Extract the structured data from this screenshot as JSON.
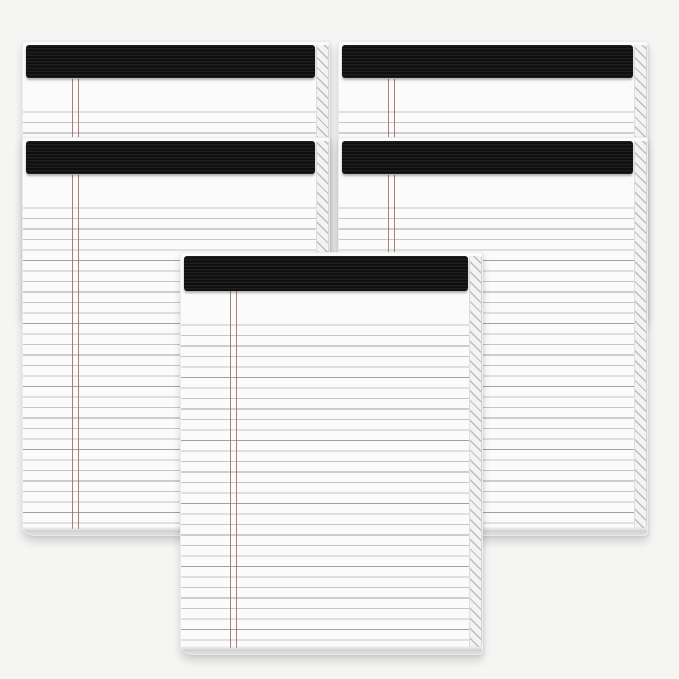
{
  "scene": {
    "title": "Five ruled writing pads with black headband bindings on a light gray backdrop",
    "pad_count": 5,
    "background_color": "#f5f5f4",
    "colors": {
      "binding": "#0d0d0d",
      "binding_texture": "#1f1f1f",
      "paper": "#fbfbfb",
      "rule_line": "#c5c5c5",
      "rule_line_dark": "#a2a2a2",
      "margin_line": "#9f7068",
      "stack_edge": "#f3f3f3",
      "stack_hatch": "#bdbdbd",
      "paper_edge": "#dedede",
      "bottom_curl": "#d0d0d0"
    },
    "pads": [
      {
        "id": "back-left",
        "left": 22,
        "top": 41,
        "width": 308,
        "height": 281,
        "z": 1,
        "binding_height": 33
      },
      {
        "id": "back-right",
        "left": 338,
        "top": 41,
        "width": 310,
        "height": 281,
        "z": 1,
        "binding_height": 33
      },
      {
        "id": "mid-left",
        "left": 22,
        "top": 137,
        "width": 308,
        "height": 399,
        "z": 2,
        "binding_height": 33
      },
      {
        "id": "mid-right",
        "left": 338,
        "top": 137,
        "width": 310,
        "height": 399,
        "z": 2,
        "binding_height": 33
      },
      {
        "id": "front-center",
        "left": 180,
        "top": 252,
        "width": 303,
        "height": 403,
        "z": 3,
        "binding_height": 35
      }
    ]
  }
}
